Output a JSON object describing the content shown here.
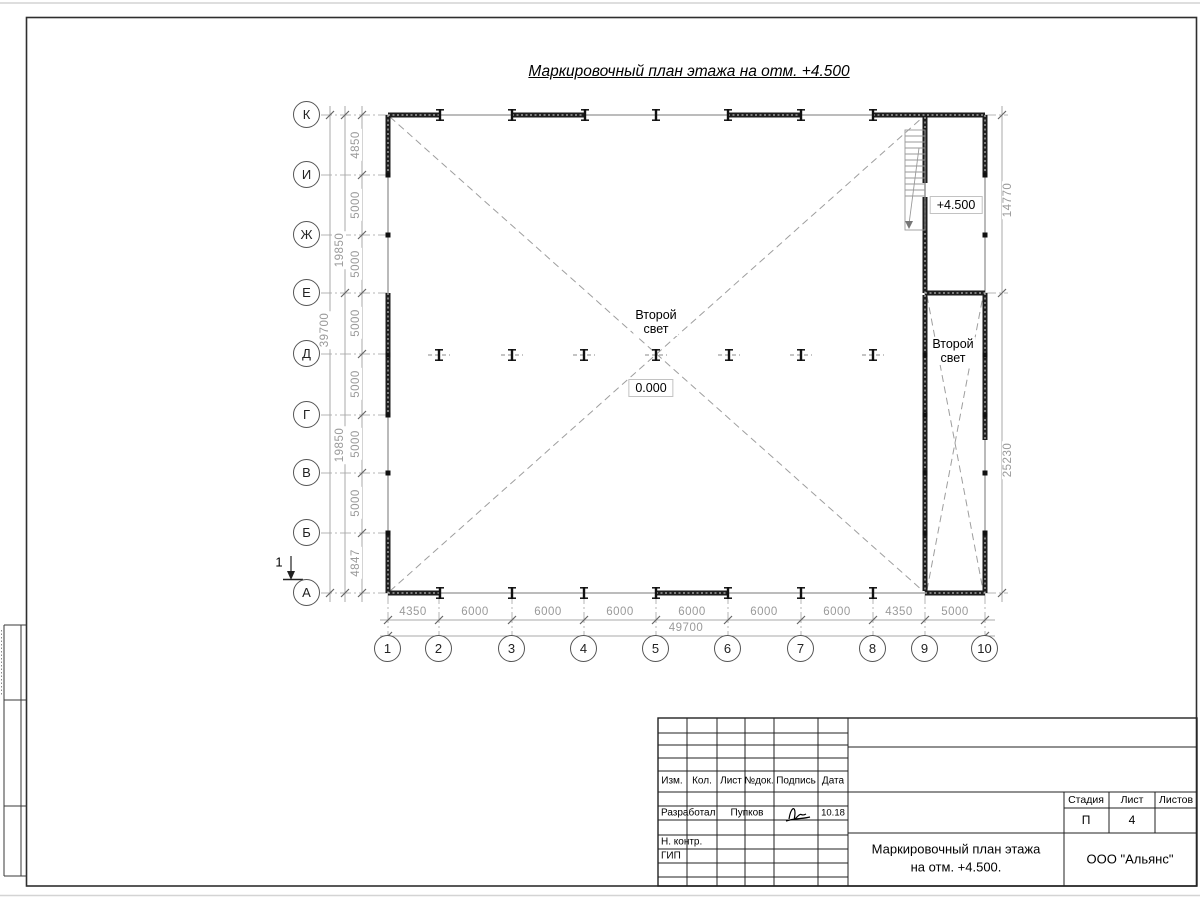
{
  "sheet": {
    "title": "Маркировочный план этажа на отм. +4.500"
  },
  "plan": {
    "row_axes": [
      "К",
      "И",
      "Ж",
      "Е",
      "Д",
      "Г",
      "В",
      "Б",
      "А"
    ],
    "col_axes": [
      "1",
      "2",
      "3",
      "4",
      "5",
      "6",
      "7",
      "8",
      "9",
      "10"
    ],
    "left_dims": [
      "4850",
      "5000",
      "5000",
      "5000",
      "5000",
      "5000",
      "5000",
      "4847"
    ],
    "left_group_dims": [
      "19850",
      "19850"
    ],
    "left_total_dim": "39700",
    "right_dims": [
      "14770",
      "25230"
    ],
    "bottom_dims": [
      "4350",
      "6000",
      "6000",
      "6000",
      "6000",
      "6000",
      "6000",
      "4350",
      "5000"
    ],
    "bottom_total_dim": "49700",
    "second_light": {
      "line1": "Второй",
      "line2": "свет"
    },
    "zero_level": "0.000",
    "upper_level": "+4.500",
    "section_mark": "1"
  },
  "title_block": {
    "columns": [
      "Изм.",
      "Кол.",
      "Лист",
      "№док.",
      "Подпись",
      "Дата"
    ],
    "developed_by_label": "Разработал",
    "developed_by_name": "Пупков",
    "date": "10.18",
    "n_control_label": "Н. контр.",
    "gip_label": "ГИП",
    "stage_label": "Стадия",
    "sheet_label": "Лист",
    "sheets_label": "Листов",
    "stage_value": "П",
    "sheet_value": "4",
    "doc_title_line1": "Маркировочный план этажа",
    "doc_title_line2": "на отм. +4.500.",
    "company": "ООО \"Альянс\""
  }
}
